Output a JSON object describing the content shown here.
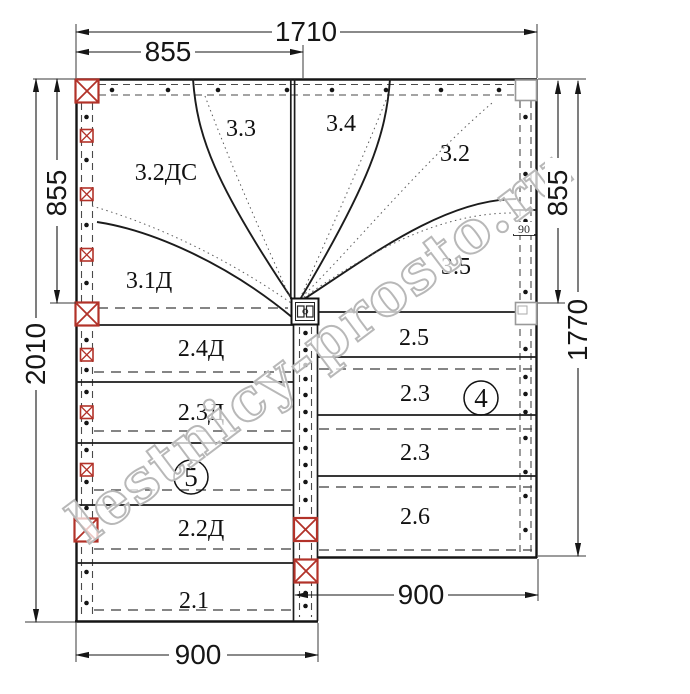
{
  "watermark": "lestnicy-prosto.ru",
  "colors": {
    "post_red": "#b23229",
    "line_black": "#1a1a1a",
    "watermark_gray": "#b8b8b8"
  },
  "dims": {
    "top_total": "1710",
    "top_half": "855",
    "left_upper": "855",
    "left_total": "2010",
    "right_upper": "855",
    "right_total": "1770",
    "bottom_left": "900",
    "bottom_right": "900",
    "stringer_mini": "90"
  },
  "labels": {
    "w_32dc": "3.2ДС",
    "w_33": "3.3",
    "w_34": "3.4",
    "w_32": "3.2",
    "w_31d": "3.1Д",
    "w_35": "3.5",
    "t_24d": "2.4Д",
    "t_25": "2.5",
    "t_23d": "2.3Д",
    "t_23a": "2.3",
    "t_23b": "2.3",
    "t_22d": "2.2Д",
    "t_26": "2.6",
    "t_21": "2.1"
  },
  "flight_markers": {
    "left": "5",
    "right": "4"
  }
}
